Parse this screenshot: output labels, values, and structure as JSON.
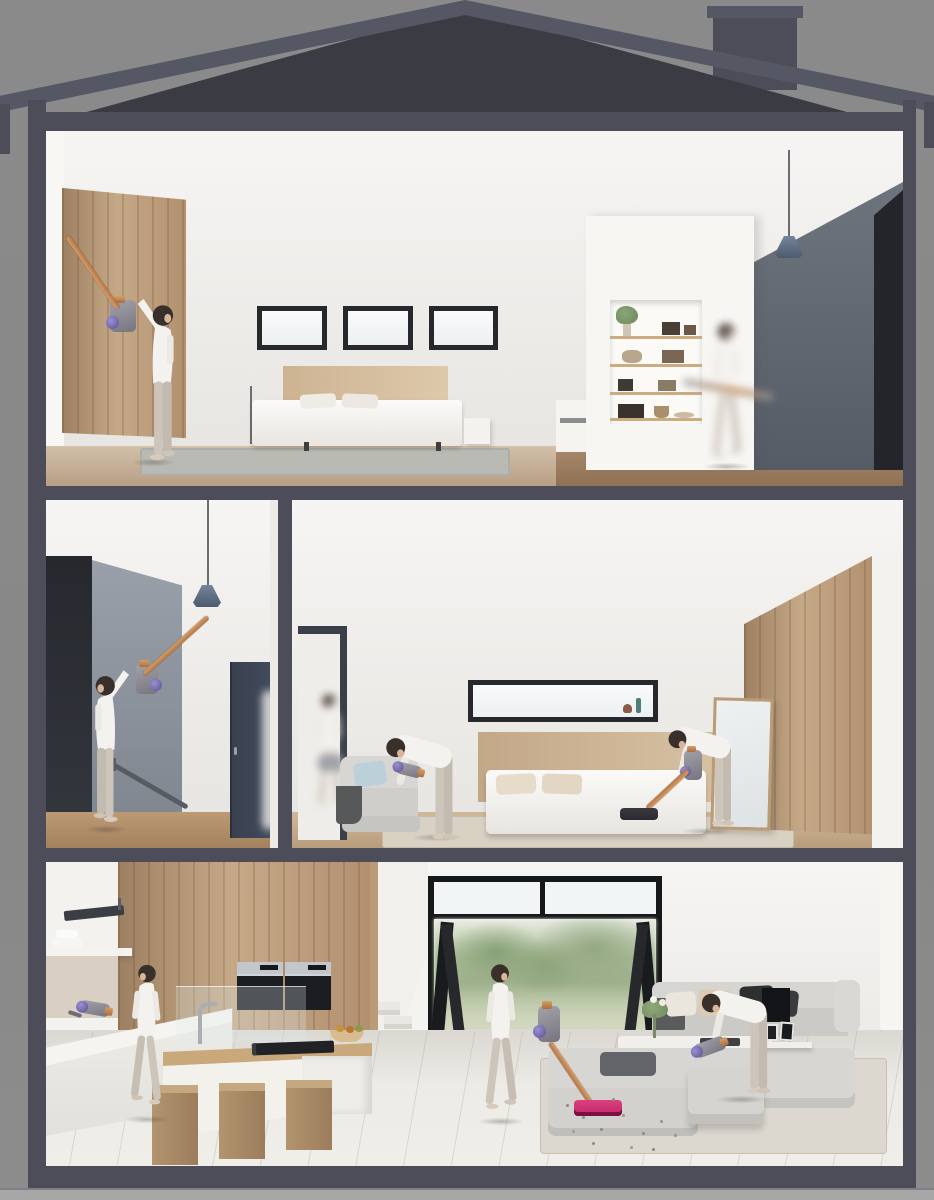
{
  "meta": {
    "description": "Cutaway cross-section illustration of a modern three-storey house; in every room a woman cleans with a cordless stick vacuum (copper wand, purple cyclone, pink floorhead).",
    "style": "photorealistic 3D render, dollhouse section view",
    "visible_text": "none"
  },
  "palette": {
    "bg": "#8a8a8a",
    "ground": "#a7a7a7",
    "frame": "#4c4d58",
    "fascia": "#565764",
    "roof": "#3a3b43",
    "interior-white": "#f2f1ee",
    "wood-light": "#c8ae8e",
    "wood-mid": "#b3926e",
    "wood-dark": "#9b7c5f",
    "accent-dark": "#23252b",
    "accent-gray": "#8d949e",
    "navy-door": "#414b5c",
    "window-frame": "#26282e",
    "glass": "#f4f6f7",
    "pendant-blue": "#5f6c80",
    "copper": "#b5764a",
    "vac-gray": "#8f8e98",
    "vac-purple": "#5a4f92",
    "vac-pink": "#c42566",
    "sofa-gray": "#d4d3cf",
    "pillow-black": "#2e2f31",
    "pillow-beige": "#dbcbb2",
    "pillow-blue": "#bcd0da",
    "garden-foliage": "#9daf8d",
    "garden-lawn": "#c3cdb2",
    "tile": "#e7e5e0",
    "skin": "#d9b69c",
    "hair": "#39302b",
    "outfit": "#f4f2ee",
    "leggings": "#cdc5ba"
  },
  "structure": {
    "roof": "gabled dark roof with chimney right of centre",
    "shell": "dark slate cut-away frame: two side walls, three floor slabs, base plinth",
    "ground": "light grey ground line under the house",
    "floors_count": 3
  },
  "floors": [
    {
      "id": "top",
      "name": "loft bedroom floor",
      "areas": [
        {
          "name": "bedroom",
          "objects": [
            "wood wardrobe wall",
            "three small windows",
            "double bed with wood headboard",
            "beige pillows",
            "area rug",
            "thin floor lamp",
            "nightstand",
            "light wood floor"
          ],
          "people": [
            {
              "pose": "reaching-up",
              "activity": "vacuuming top of wardrobe with stick vacuum"
            }
          ]
        },
        {
          "name": "landing",
          "objects": [
            "white column with recessed shelving niche",
            "potted plant and decor objects",
            "blue pendant lamp",
            "grey accent wall",
            "near-black corner wall",
            "dark wood floor"
          ],
          "people": [
            {
              "pose": "walking",
              "activity": "motion-blurred, carrying vacuum wand"
            }
          ]
        }
      ]
    },
    {
      "id": "middle",
      "name": "second storey",
      "areas": [
        {
          "name": "stair hall",
          "objects": [
            "near-black feature wall",
            "grey stair wall",
            "stair handrail",
            "navy interior door",
            "blue pendant lamp",
            "wood floor"
          ],
          "people": [
            {
              "pose": "reaching-up",
              "activity": "vacuuming around pendant lamp with extended wand"
            }
          ]
        },
        {
          "name": "master bedroom",
          "objects": [
            "doorway with dark frame",
            "armchair with blue cushion and dark throw",
            "letterbox window with small ornaments",
            "double bed with wood headboard",
            "leaning mirror",
            "wood wardrobe",
            "area rug",
            "wood floor"
          ],
          "people": [
            {
              "pose": "walking",
              "activity": "motion-blurred, entering through doorway"
            },
            {
              "pose": "bending",
              "activity": "vacuuming armchair with handheld vacuum"
            },
            {
              "pose": "bending",
              "activity": "vacuuming floor at bed with stick vacuum"
            }
          ]
        }
      ]
    },
    {
      "id": "ground",
      "name": "ground floor",
      "areas": [
        {
          "name": "kitchen",
          "objects": [
            "wood panel wall",
            "cooker hood",
            "open shelf with stacked dishes",
            "two built-in ovens",
            "white worktop",
            "island with timber top, sink tap, gas hob, fruit bowl",
            "glass splash screen",
            "three wooden block stools",
            "tile floor"
          ],
          "people": [
            {
              "pose": "standing",
              "activity": "vacuuming worktop with handheld vacuum"
            }
          ]
        },
        {
          "name": "living room",
          "objects": [
            "white staircase",
            "black-framed bi-fold glass doors",
            "garden view with trees and lawn",
            "corner sofa with black and beige cushions",
            "coffee table with flowers and tray",
            "ottoman",
            "area rug",
            "tower air-purifier fan",
            "wall TV",
            "shelf with picture frames",
            "debris specks on floor"
          ],
          "people": [
            {
              "pose": "standing",
              "activity": "vacuuming floor with stick vacuum, pink cleaner head"
            },
            {
              "pose": "bending",
              "activity": "vacuuming ottoman with handheld vacuum"
            }
          ]
        }
      ]
    }
  ]
}
